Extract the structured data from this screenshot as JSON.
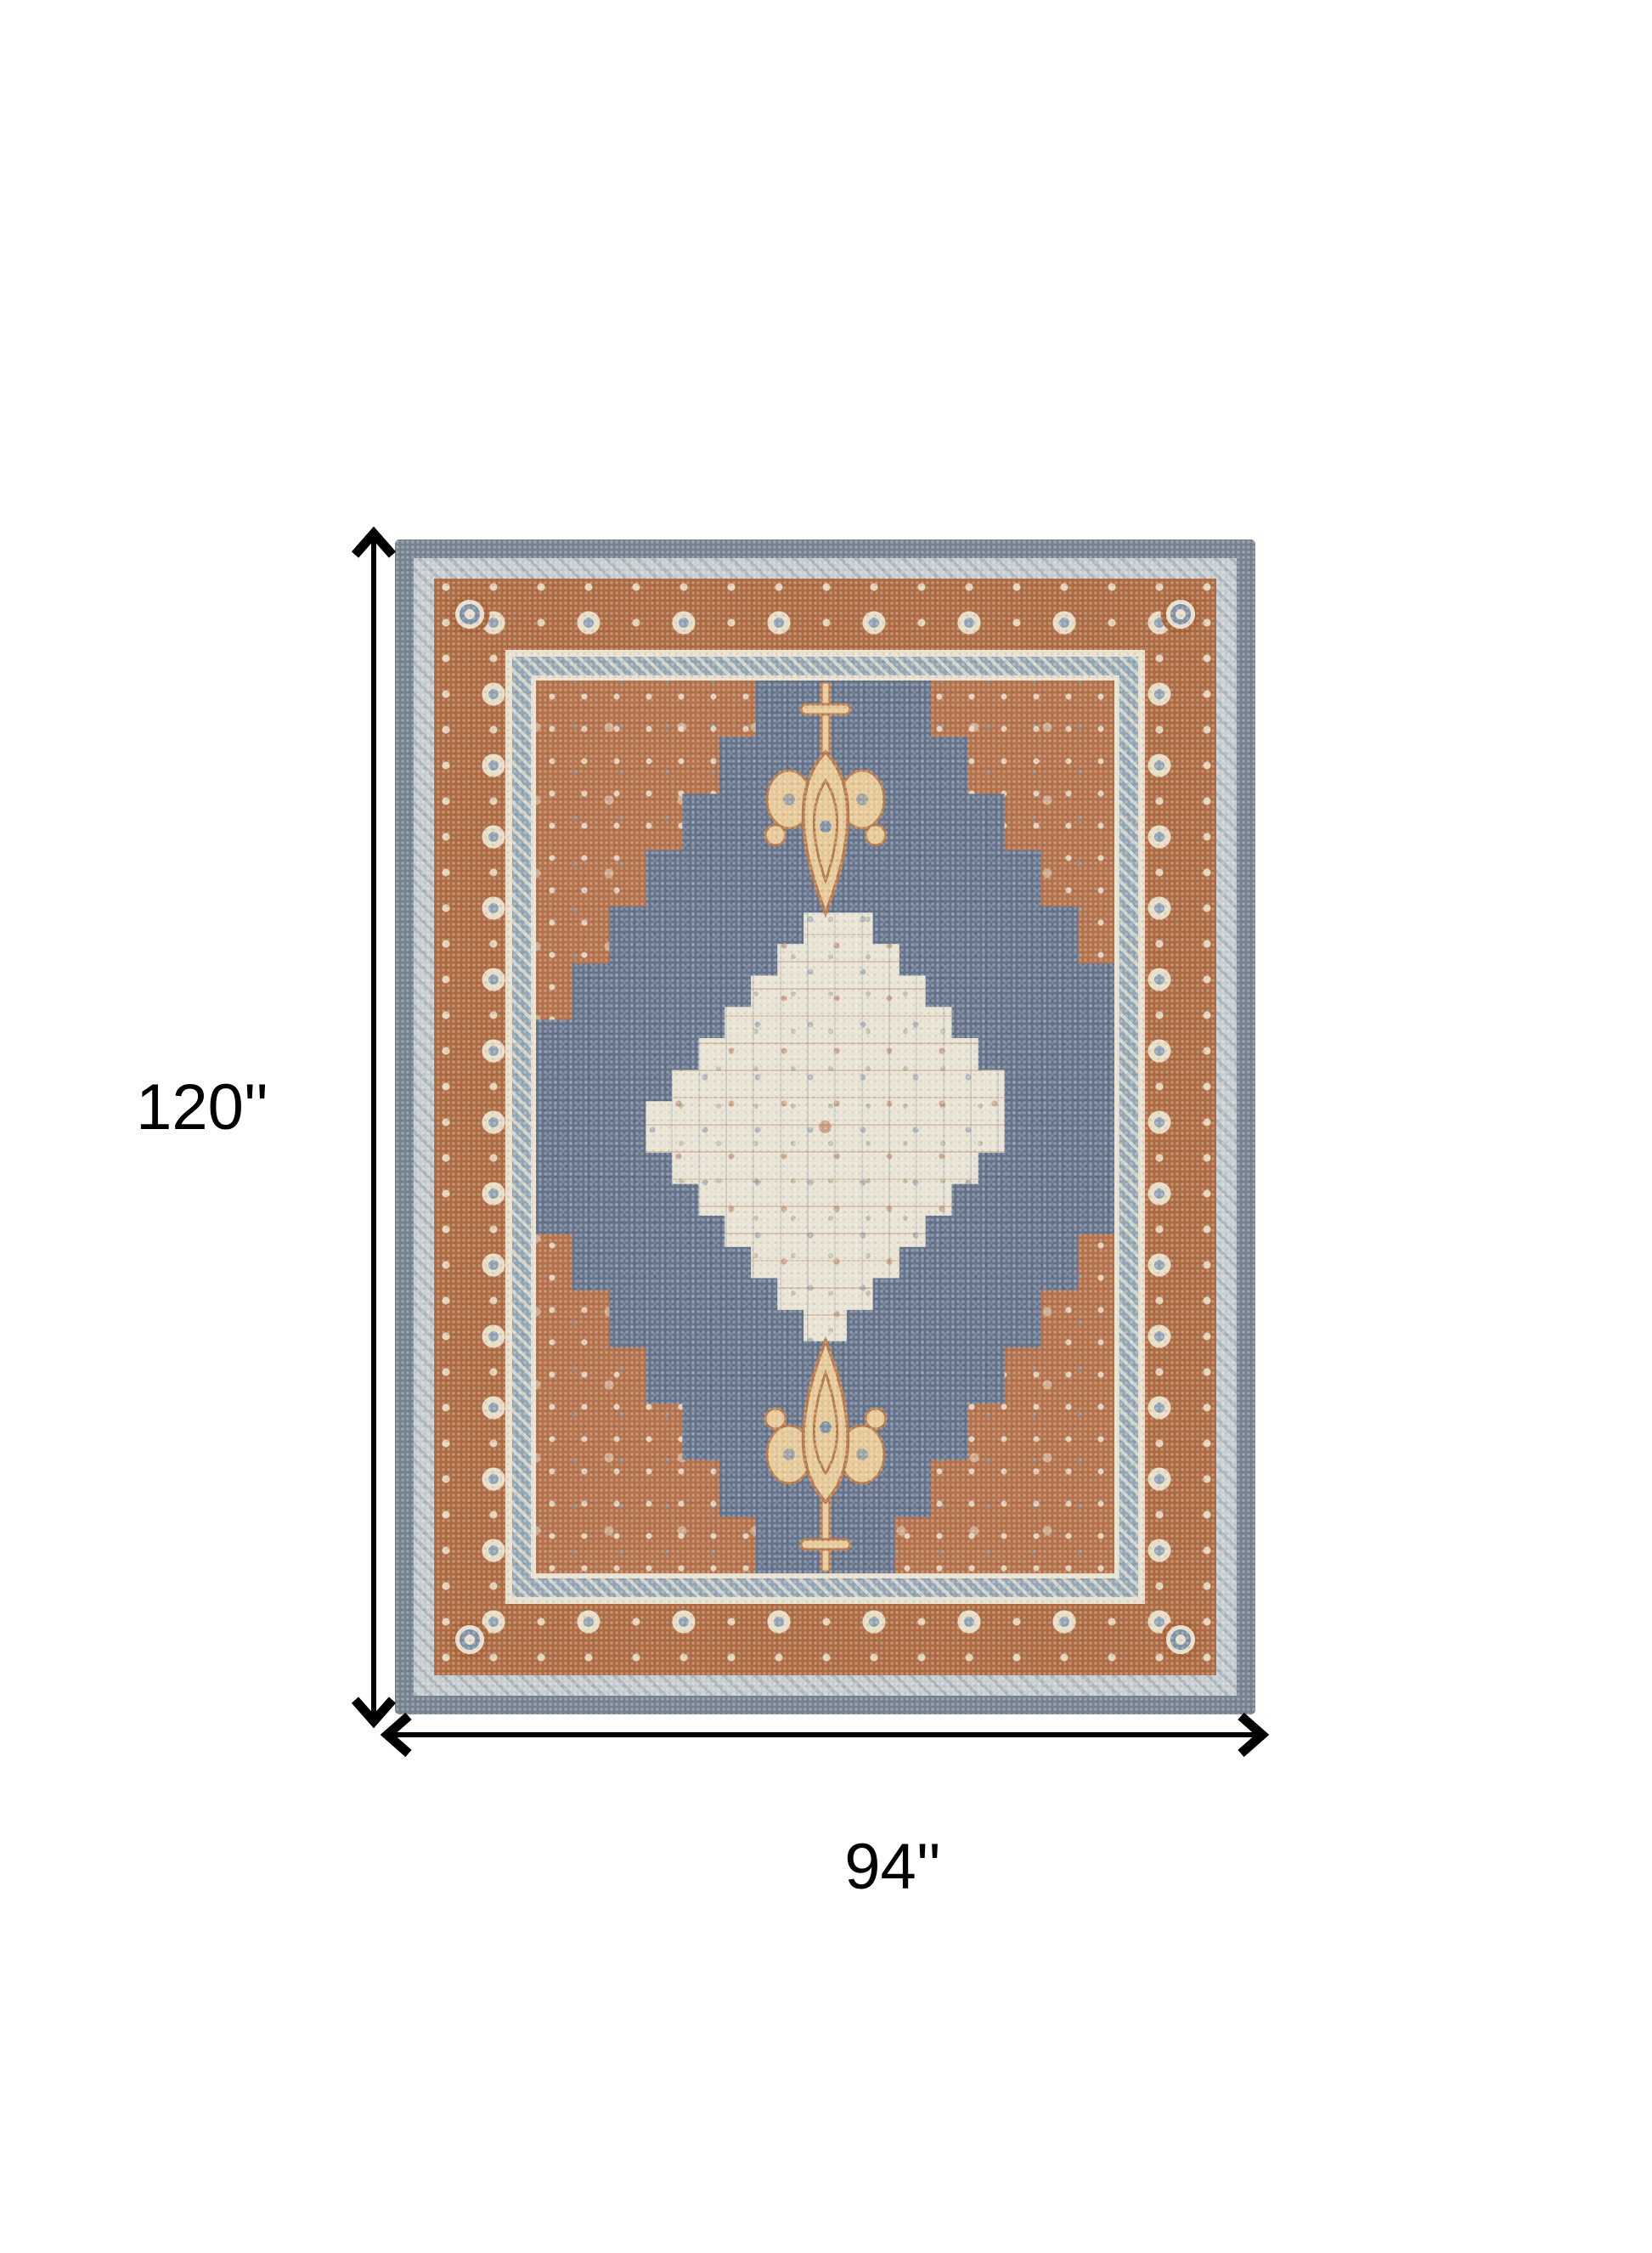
{
  "diagram": {
    "type": "product-dimension-diagram",
    "subject": "traditional medallion area rug, rust and slate blue with cream center",
    "background": "#ffffff"
  },
  "labels": {
    "height": "120''",
    "width": "94''"
  },
  "arrows": {
    "color": "#000000",
    "height_axis": "vertical-double-arrow",
    "width_axis": "horizontal-double-arrow"
  },
  "rug_colors": {
    "outer_band": "#75828F",
    "light_band": "#C9CFD1",
    "rust_border": "#AE6B42",
    "cream_line": "#E9E1CF",
    "inner_blue_band": "#92A5B2",
    "field_rust": "#B4714A",
    "field_blue": "#63728A",
    "medallion_cream": "#E9E3D3",
    "finial_gold": "#E6C997",
    "finial_outline": "#B5794D",
    "accent_blue": "#7E92A4"
  }
}
